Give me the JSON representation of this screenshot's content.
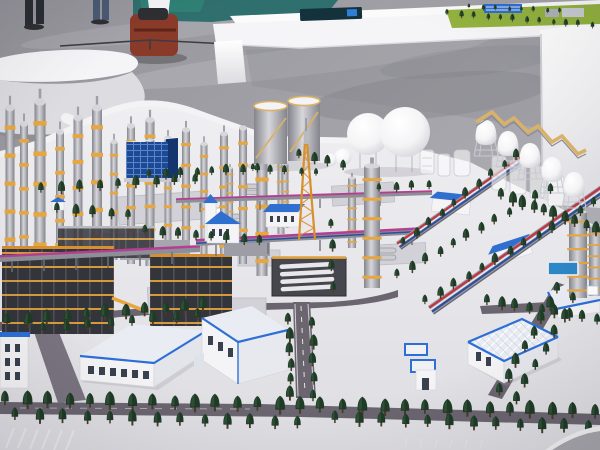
{
  "meta": {
    "title": "Exhibition photograph: scale model of a petrochemical refinery complex on a white base, with white display tables and hall floor behind",
    "scene_type": "photograph",
    "no_visible_text": true
  },
  "colors": {
    "hall_floor_a": "#94939a",
    "hall_floor_b": "#b8b7bd",
    "floor_streak": "#e6e5ea",
    "floor_smudge": "#6f6e75",
    "teal": "#2f6f6d",
    "teal_bright": "#2f8577",
    "furniture_white": "#f5f5f7",
    "furniture_shade": "#dcdce1",
    "under_shadow": "#85848c",
    "screen_dark": "#13323b",
    "screen_item": "#2f7fd6",
    "grass": "#93b23f",
    "ground_a": "#efeff2",
    "ground_b": "#dedde2",
    "pad": "#d2d1d7",
    "pad_edge": "#bcbbc2",
    "road": "#6b6570",
    "road_light": "#7a7480",
    "marking": "#eeeef0",
    "tree_dark": "#1f3a26",
    "tree_mid": "#33583a",
    "trunk": "#4a3b2b",
    "col_light": "#d6d6db",
    "col_mid": "#9fa0a7",
    "col_dark": "#84858c",
    "band_yellow": "#e7a63e",
    "band_orange": "#d88f2e",
    "steel_dark": "#34343b",
    "steel_line": "#4e4e56",
    "glass_blue": "#1c4a96",
    "glass_line": "#5b84c4",
    "roof_blue": "#2f6fd0",
    "trim_blue": "#2e6fd6",
    "roof_light": "#e9edf3",
    "pipe_magenta": "#b43e92",
    "pipe_red": "#c23440",
    "pipe_blue": "#2c4f9c",
    "pipe_white": "#e8e8ec",
    "tank_white": "#f4f4f6",
    "tank_shade": "#c9c9d1",
    "walkway_tan": "#d8b268",
    "basin_blue": "#2d86c6",
    "bag_red": "#8a3a28",
    "bag_dark": "#2f2f33",
    "jeans": "#4a5a74",
    "pants": "#2b2d33",
    "window_dark": "#39404e",
    "white": "#ffffff"
  },
  "objects": {
    "background": [
      "exhibition hall floor",
      "visitor legs",
      "travel bag",
      "teal floor patch",
      "white display table",
      "tabletop screen inset",
      "mini site model on table",
      "white curved bench"
    ],
    "model": [
      "white base with curved edge",
      "distillation columns with yellow platform rings",
      "dark steel process structures",
      "blue glass office building",
      "two storage tanks with spiral stairs",
      "white spherical tanks",
      "row of dome-top tanks with tan walkway",
      "orange flare derrick",
      "chapel-shaped unit with blue roof",
      "blue-roof field buildings",
      "horizontal pipe racks with magenta pipes",
      "diagonal pipe racks with red white and blue pipes",
      "white lattice structures",
      "tree-lined roads",
      "warehouses with blue-trimmed roofs",
      "utility basins and pump hut",
      "blue water basin",
      "parking stripes"
    ]
  }
}
